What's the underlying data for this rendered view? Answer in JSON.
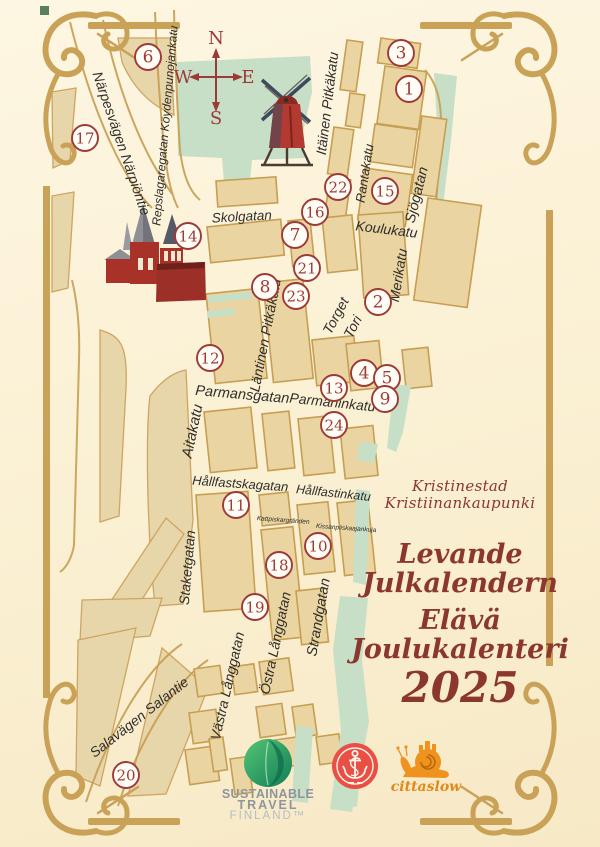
{
  "titles": {
    "city_sv": "Kristinestad",
    "city_fi": "Kristiinankaupunki",
    "event_sv_1": "Levande",
    "event_sv_2": "Julkalendern",
    "event_fi_1": "Elävä",
    "event_fi_2": "Joulukalenteri",
    "year": "2025"
  },
  "logos": {
    "sustainable": {
      "line1": "SUSTAINABLE",
      "line2": "TRAVEL",
      "line3": "FINLAND™"
    },
    "cittaslow": {
      "label": "cittaslow"
    },
    "city_badge": {
      "name": "anchor-badge"
    }
  },
  "map": {
    "compass": {
      "north": "N",
      "south": "S",
      "west": "W",
      "east": "E"
    },
    "markers": [
      {
        "n": 1,
        "x": 409,
        "y": 89
      },
      {
        "n": 2,
        "x": 378,
        "y": 302
      },
      {
        "n": 3,
        "x": 401,
        "y": 53
      },
      {
        "n": 4,
        "x": 364,
        "y": 373
      },
      {
        "n": 5,
        "x": 387,
        "y": 378
      },
      {
        "n": 6,
        "x": 148,
        "y": 57
      },
      {
        "n": 7,
        "x": 295,
        "y": 235
      },
      {
        "n": 8,
        "x": 265,
        "y": 287
      },
      {
        "n": 9,
        "x": 385,
        "y": 399
      },
      {
        "n": 10,
        "x": 318,
        "y": 546
      },
      {
        "n": 11,
        "x": 236,
        "y": 505
      },
      {
        "n": 12,
        "x": 210,
        "y": 358
      },
      {
        "n": 13,
        "x": 334,
        "y": 388
      },
      {
        "n": 14,
        "x": 188,
        "y": 236
      },
      {
        "n": 15,
        "x": 385,
        "y": 191
      },
      {
        "n": 16,
        "x": 315,
        "y": 212
      },
      {
        "n": 17,
        "x": 85,
        "y": 138
      },
      {
        "n": 18,
        "x": 279,
        "y": 565
      },
      {
        "n": 19,
        "x": 255,
        "y": 607
      },
      {
        "n": 20,
        "x": 126,
        "y": 775
      },
      {
        "n": 21,
        "x": 307,
        "y": 268
      },
      {
        "n": 22,
        "x": 338,
        "y": 187
      },
      {
        "n": 23,
        "x": 296,
        "y": 296
      },
      {
        "n": 24,
        "x": 334,
        "y": 425
      }
    ],
    "streets": [
      {
        "name": "Skolgatan",
        "x": 242,
        "y": 221,
        "rot": -3,
        "size": 13.5
      },
      {
        "name": "Koulukatu",
        "x": 386,
        "y": 234,
        "rot": 7,
        "size": 14
      },
      {
        "name": "Itäinen Pitkäkatu",
        "x": 332,
        "y": 104,
        "rot": -83,
        "size": 14
      },
      {
        "name": "Rantakatu",
        "x": 369,
        "y": 174,
        "rot": -81,
        "size": 13
      },
      {
        "name": "Sjögatan",
        "x": 421,
        "y": 196,
        "rot": -76,
        "size": 14.5
      },
      {
        "name": "Merikatu",
        "x": 403,
        "y": 276,
        "rot": -81,
        "size": 14
      },
      {
        "name": "Torget",
        "x": 340,
        "y": 318,
        "rot": -62,
        "size": 14
      },
      {
        "name": "Tori",
        "x": 357,
        "y": 329,
        "rot": -62,
        "size": 14
      },
      {
        "name": "Läntinen Pitkäkatu",
        "x": 270,
        "y": 336,
        "rot": -79,
        "size": 14
      },
      {
        "name": "Parmansgatan",
        "x": 242,
        "y": 399,
        "rot": 5,
        "size": 14.5
      },
      {
        "name": "Parmaninkatu",
        "x": 332,
        "y": 407,
        "rot": 6,
        "size": 14
      },
      {
        "name": "Aitakatu",
        "x": 197,
        "y": 432,
        "rot": -78,
        "size": 15
      },
      {
        "name": "Hållfastskagatan",
        "x": 240,
        "y": 488,
        "rot": 4,
        "size": 13
      },
      {
        "name": "Hållfastinkatu",
        "x": 333,
        "y": 497,
        "rot": 6,
        "size": 12.5
      },
      {
        "name": "Kattpiskargränden",
        "x": 283,
        "y": 522,
        "rot": 4,
        "size": 6.5
      },
      {
        "name": "Kissanpiiskaajankuja",
        "x": 346,
        "y": 530,
        "rot": 4,
        "size": 6.5
      },
      {
        "name": "Staketgatan",
        "x": 192,
        "y": 568,
        "rot": -85,
        "size": 14
      },
      {
        "name": "Strandgatan",
        "x": 323,
        "y": 618,
        "rot": -80,
        "size": 14.5
      },
      {
        "name": "Östra Långgatan",
        "x": 280,
        "y": 644,
        "rot": -78,
        "size": 14
      },
      {
        "name": "Västra Långgatan",
        "x": 232,
        "y": 687,
        "rot": -77,
        "size": 14
      },
      {
        "name": "Salavägen Salantie",
        "x": 142,
        "y": 721,
        "rot": -38,
        "size": 14
      },
      {
        "name": "Närpesvägen Närpiöntie",
        "x": 117,
        "y": 145,
        "rot": 71,
        "size": 14
      },
      {
        "name": "Repslagaregatan Köydenpunojankatu",
        "x": 169,
        "y": 126,
        "rot": -85,
        "size": 12
      }
    ],
    "landmarks": [
      "church",
      "windmill"
    ]
  },
  "colors": {
    "background": "#fbf1d5",
    "block_fill": "#ead5a2",
    "block_stroke": "#c79e52",
    "field_tan": "#e8d6ab",
    "green": "#c7dfc6",
    "frame_gold": "#c9a257",
    "marker_red": "#9e3a35",
    "title_red": "#8c372e",
    "street_text": "#2f2e2b"
  }
}
